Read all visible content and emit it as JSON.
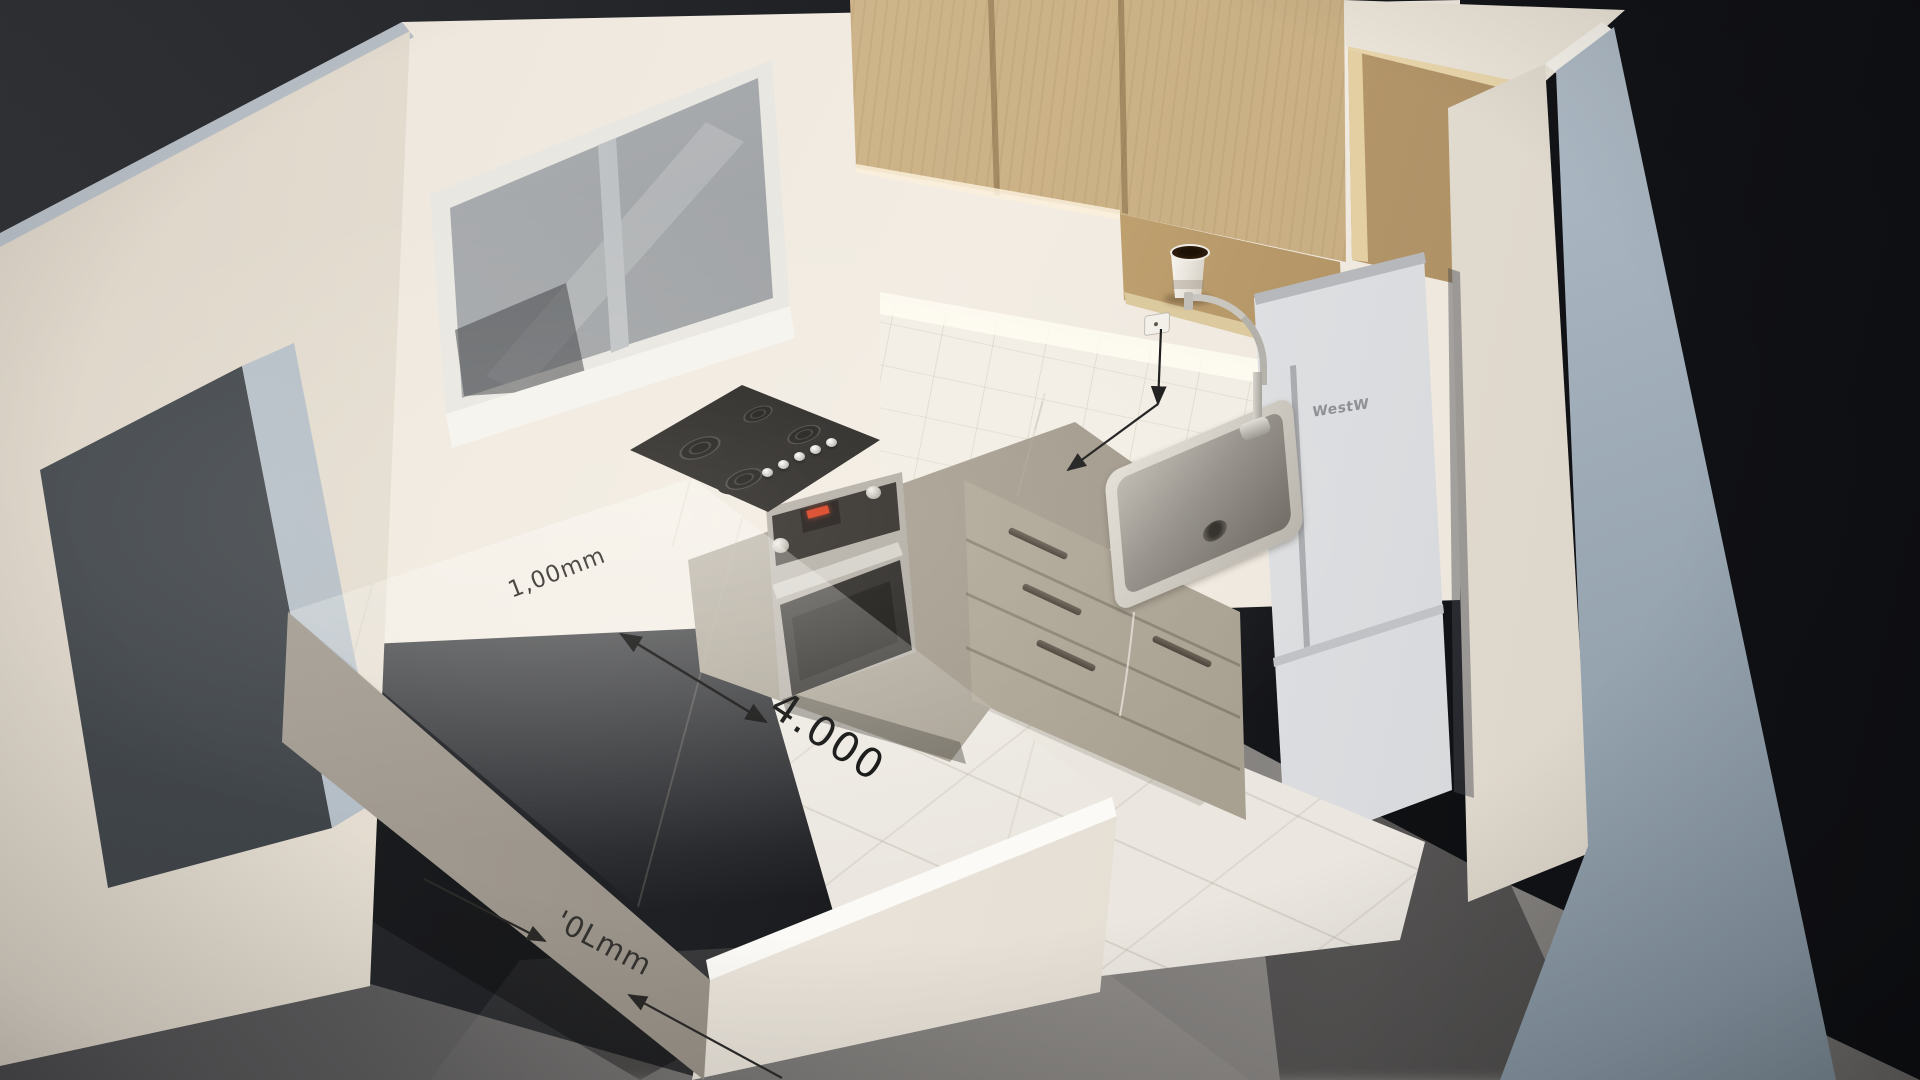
{
  "annotations": {
    "counter_marking": "1,00mm",
    "length_label": "4.000",
    "width_label": "'0Lmm"
  },
  "fridge": {
    "brand": "WestW"
  },
  "palette": {
    "background_dark": "#17181c",
    "wall_white": "#efe9e0",
    "wood_cabinet": "#ccb287",
    "countertop_marble": "#f5f1ea",
    "base_cabinet": "#b3aa9b",
    "right_wall_exterior": "#acb8c3",
    "floor_outside": "#6f6d6a",
    "floor_tiles": "#ebe7e0",
    "annotation_ink": "#1a1a1a",
    "cooktop_black": "#1f1d1b",
    "stainless_steel": "#b7b2aa",
    "oven_display_red": "#d93a1a"
  }
}
